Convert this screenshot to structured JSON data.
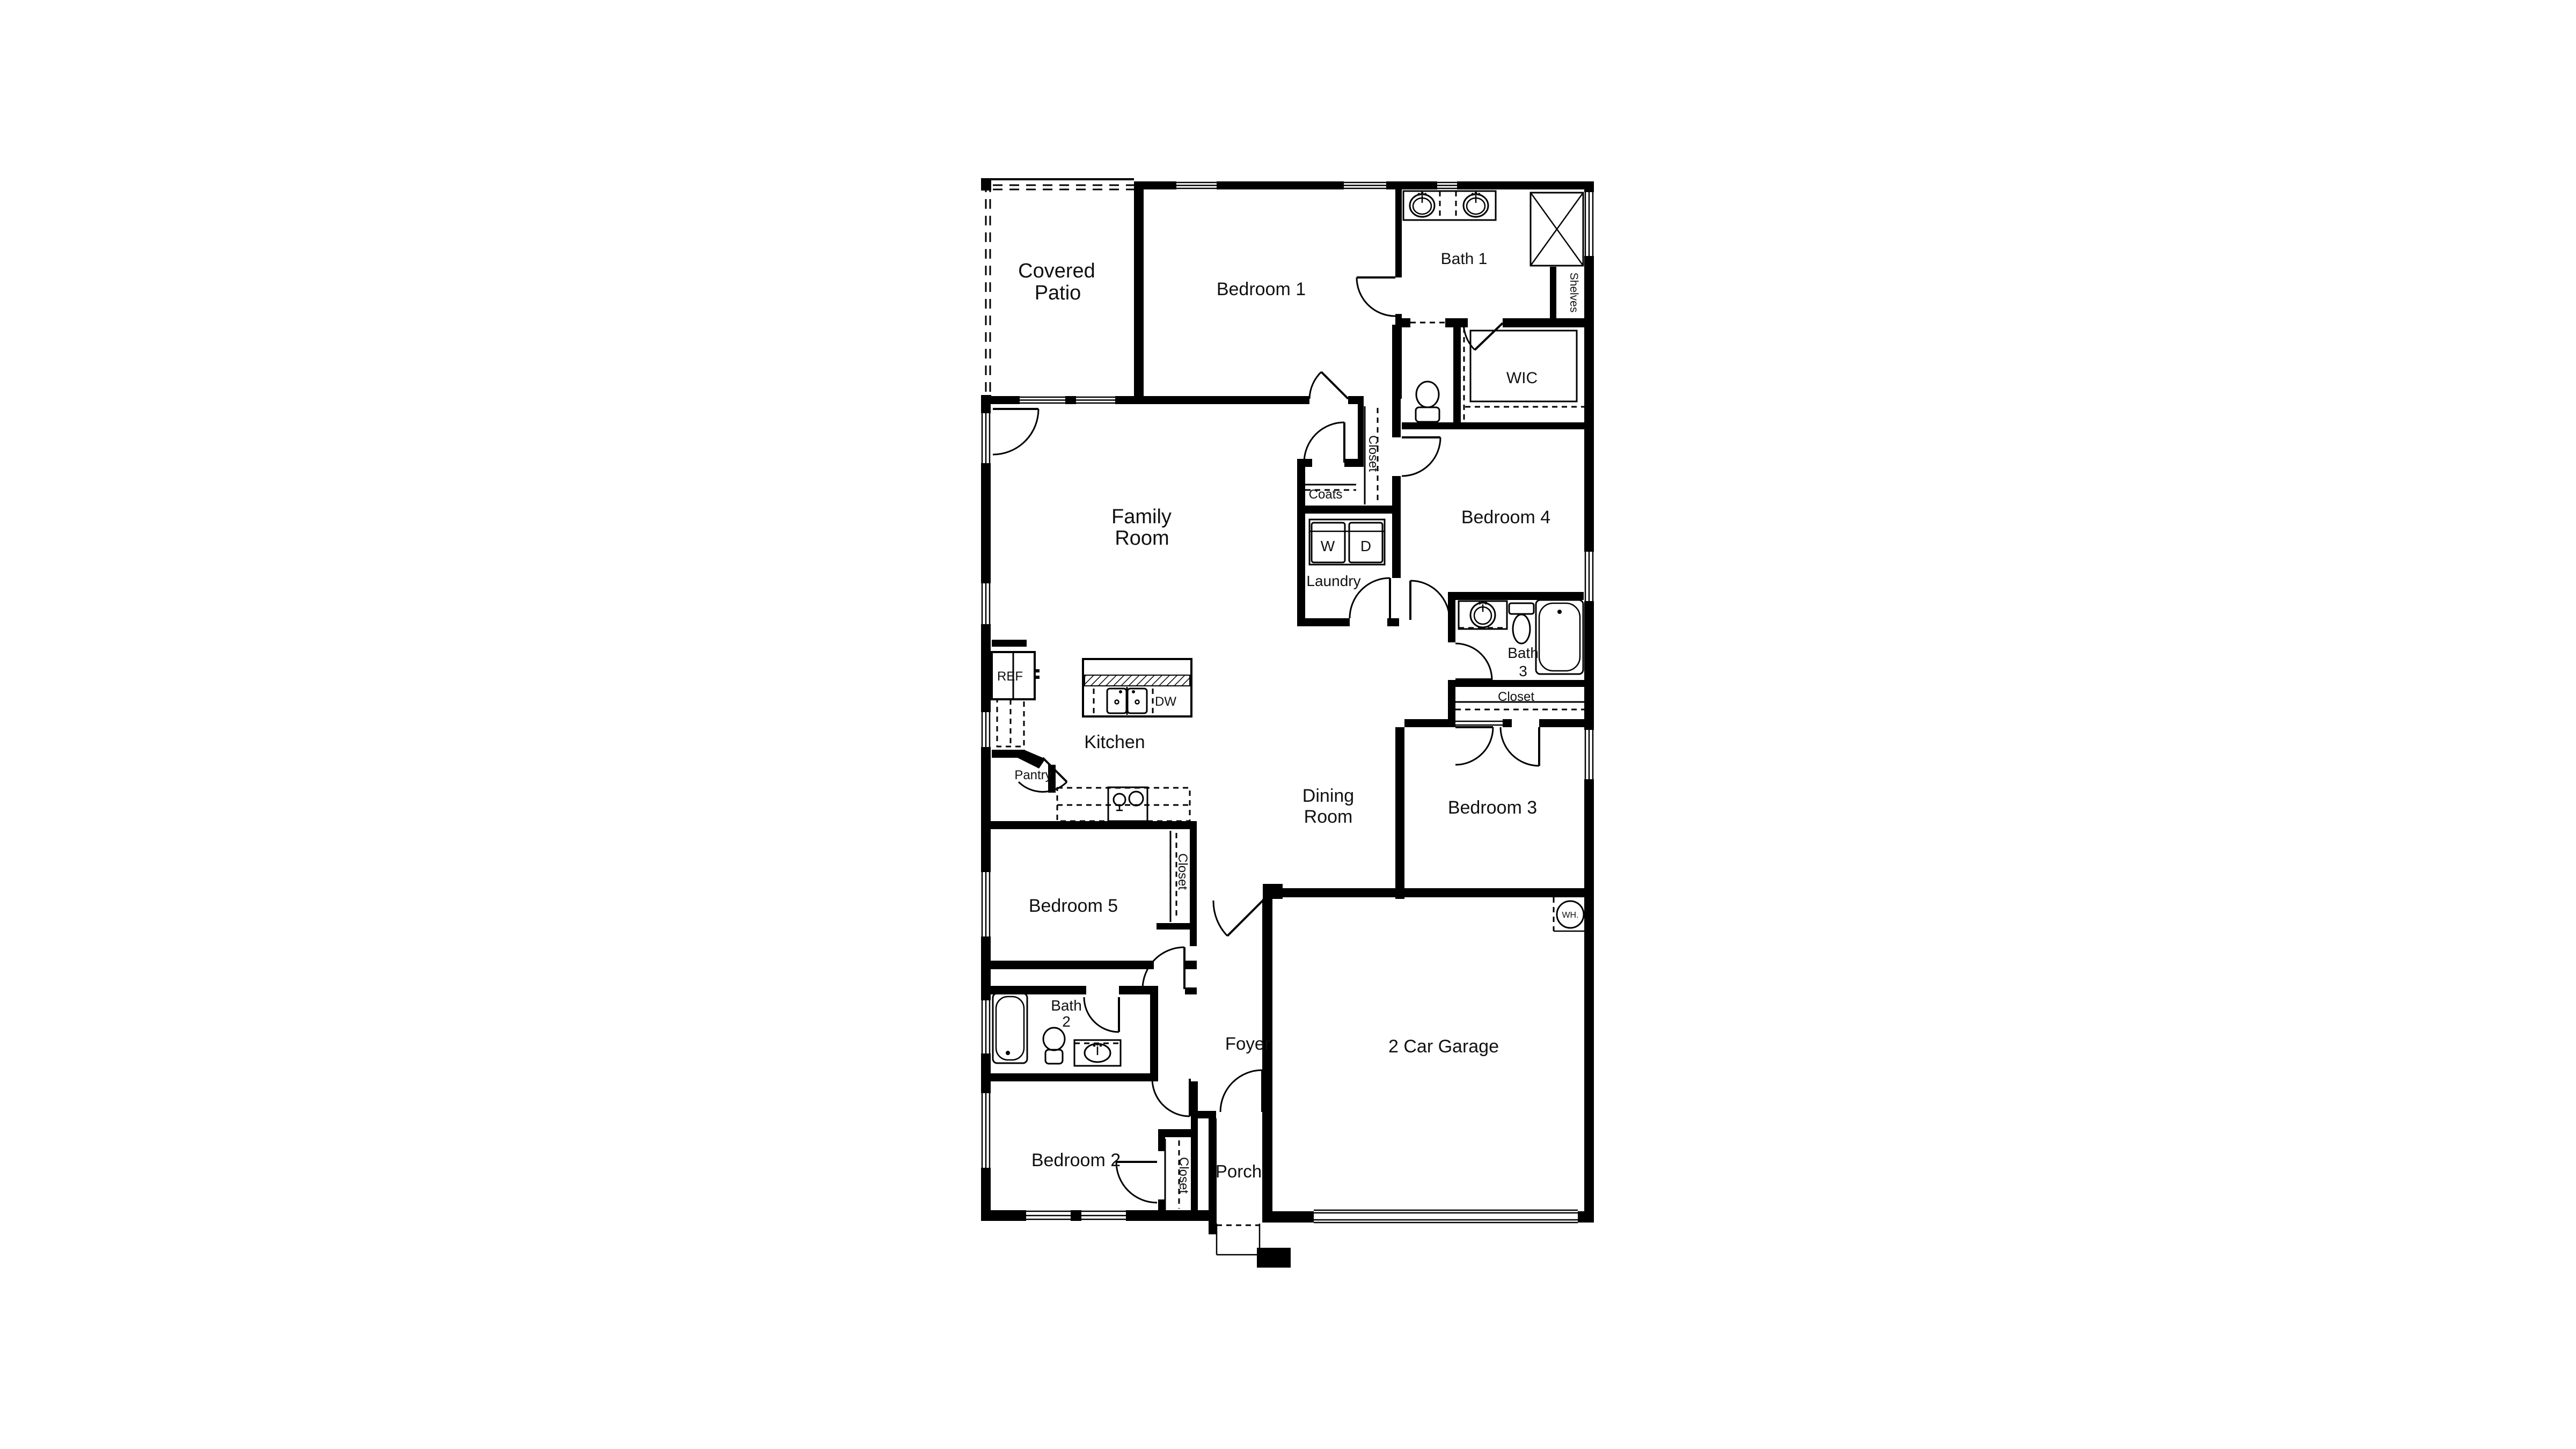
{
  "labels": {
    "covered_patio_line1": "Covered",
    "covered_patio_line2": "Patio",
    "bedroom1": "Bedroom 1",
    "bath1": "Bath 1",
    "shelves": "Shelves",
    "wic": "WIC",
    "family_line1": "Family",
    "family_line2": "Room",
    "closet_hall": "Closet",
    "coats": "Coats",
    "washer": "W",
    "dryer": "D",
    "laundry": "Laundry",
    "bedroom4": "Bedroom 4",
    "bath3_line1": "Bath",
    "bath3_line2": "3",
    "closet_bath3": "Closet",
    "kitchen": "Kitchen",
    "ref": "REF",
    "dw": "DW",
    "pantry": "Pantry",
    "dining_line1": "Dining",
    "dining_line2": "Room",
    "bedroom3": "Bedroom 3",
    "bedroom5": "Bedroom 5",
    "closet_bedroom5": "Closet",
    "bath2_line1": "Bath",
    "bath2_line2": "2",
    "foyer": "Foyer",
    "bedroom2": "Bedroom 2",
    "closet_bedroom2": "Closet",
    "porch": "Porch",
    "garage": "2 Car Garage",
    "water_heater": "WH."
  },
  "colors": {
    "wall": "#000000",
    "background": "#ffffff",
    "line": "#111111"
  }
}
